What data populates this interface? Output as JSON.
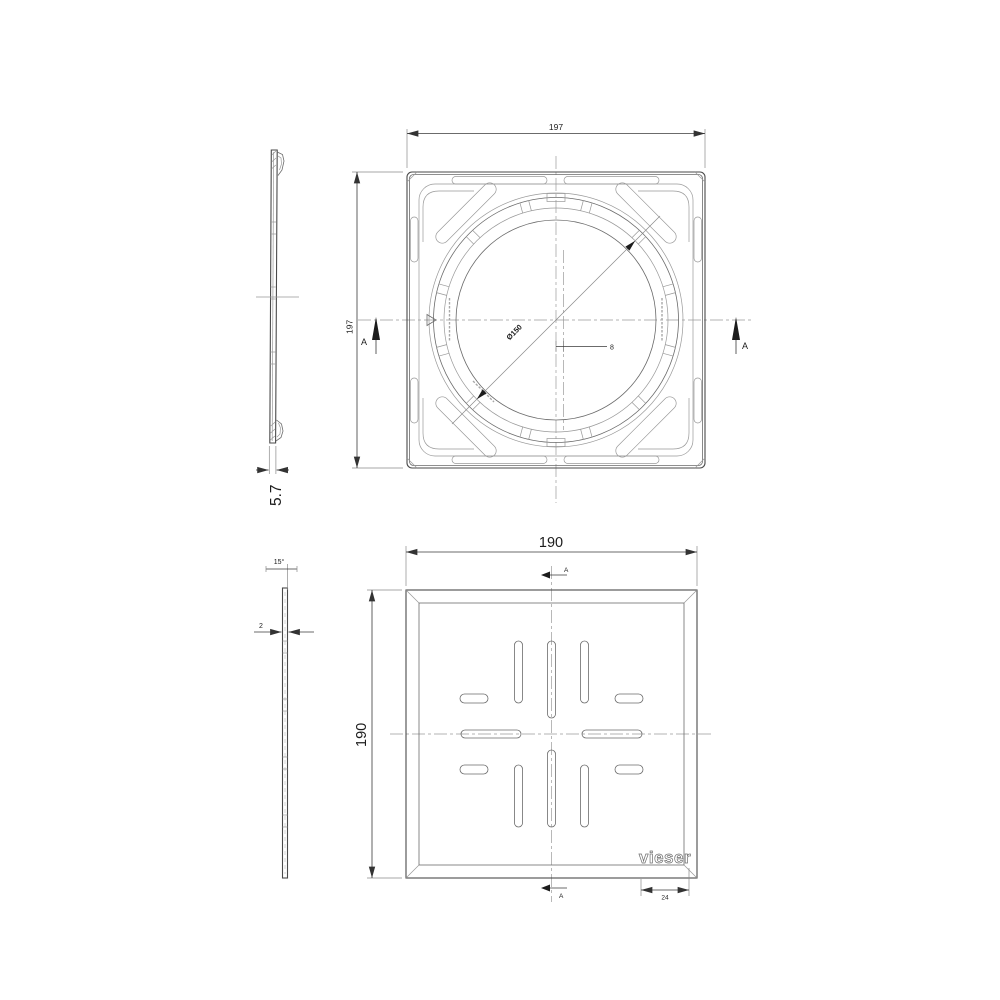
{
  "drawing": {
    "brand": "vieser",
    "section_label": "A",
    "frame": {
      "width": "197",
      "height": "197",
      "thickness": "5.7",
      "opening_diameter": "Ø150",
      "center_offset": "8"
    },
    "grate": {
      "width": "190",
      "height": "190",
      "thickness": "2",
      "edge_angle": "15°",
      "logo_inset": "24"
    }
  }
}
